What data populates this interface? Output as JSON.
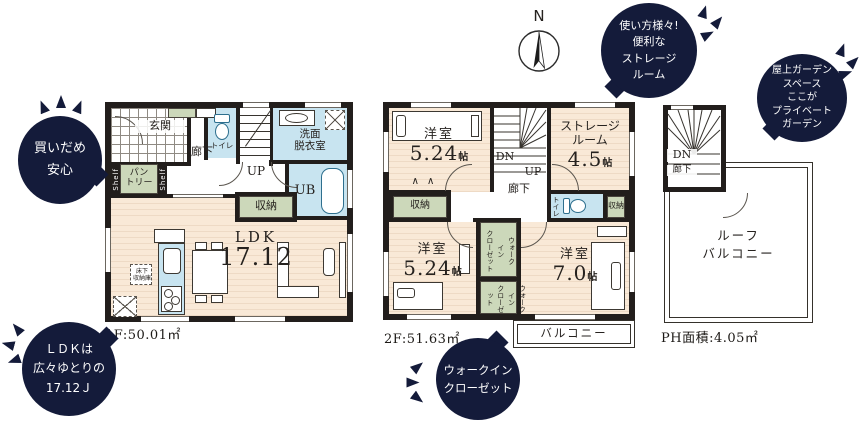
{
  "colors": {
    "wall": "#221e1c",
    "wet": "#c8e4f0",
    "wood": "#f8e8d6",
    "green": "#ccd8ba",
    "bubble": "#141b3a"
  },
  "compass": {
    "label": "N"
  },
  "f1": {
    "area": "1F:50.01㎡",
    "genkan": "玄関",
    "hall": "廊下",
    "toilet": "トイレ",
    "up": "UP",
    "wash1": "洗面",
    "wash2": "脱衣室",
    "ub": "UB",
    "shelf": "Shelf",
    "pantry1": "パン",
    "pantry2": "トリー",
    "storage": "収納",
    "ldk": "LDK",
    "ldk_num": "17.12",
    "uf1": "床下",
    "uf2": "収納庫"
  },
  "f2": {
    "area": "2F:51.63㎡",
    "dn": "DN",
    "up": "UP",
    "hall": "廊下",
    "closet": "収納",
    "toilet": "トイレ",
    "balcony": "バルコニー",
    "nw": {
      "name": "洋室",
      "num": "5.24",
      "unit": "帖"
    },
    "sr": {
      "l1": "ストレージ",
      "l2": "ルーム",
      "num": "4.5",
      "unit": "帖"
    },
    "sw": {
      "name": "洋室",
      "num": "5.24",
      "unit": "帖"
    },
    "se": {
      "name": "洋室",
      "num": "7.0",
      "unit": "帖"
    },
    "wic": {
      "l1": "ウォーク",
      "l2": "イン",
      "l3": "クローゼット"
    }
  },
  "ph": {
    "area": "PH面積:4.05㎡",
    "dn": "DN",
    "hall": "廊下",
    "roof1": "ルーフ",
    "roof2": "バルコニー"
  },
  "callouts": {
    "stock": {
      "l1": "買いだめ",
      "l2": "安心"
    },
    "ldk": {
      "l1": "ＬＤＫは",
      "l2": "広々ゆとりの",
      "l3": "17.12Ｊ"
    },
    "storage": {
      "l1": "使い方様々!",
      "l2": "便利な",
      "l3": "ストレージ",
      "l4": "ルーム"
    },
    "roof": {
      "l1": "屋上ガーデン",
      "l2": "スペース",
      "l3": "ここが",
      "l4": "プライベート",
      "l5": "ガーデン"
    },
    "wic": {
      "l1": "ウォークイン",
      "l2": "クローゼット"
    }
  }
}
